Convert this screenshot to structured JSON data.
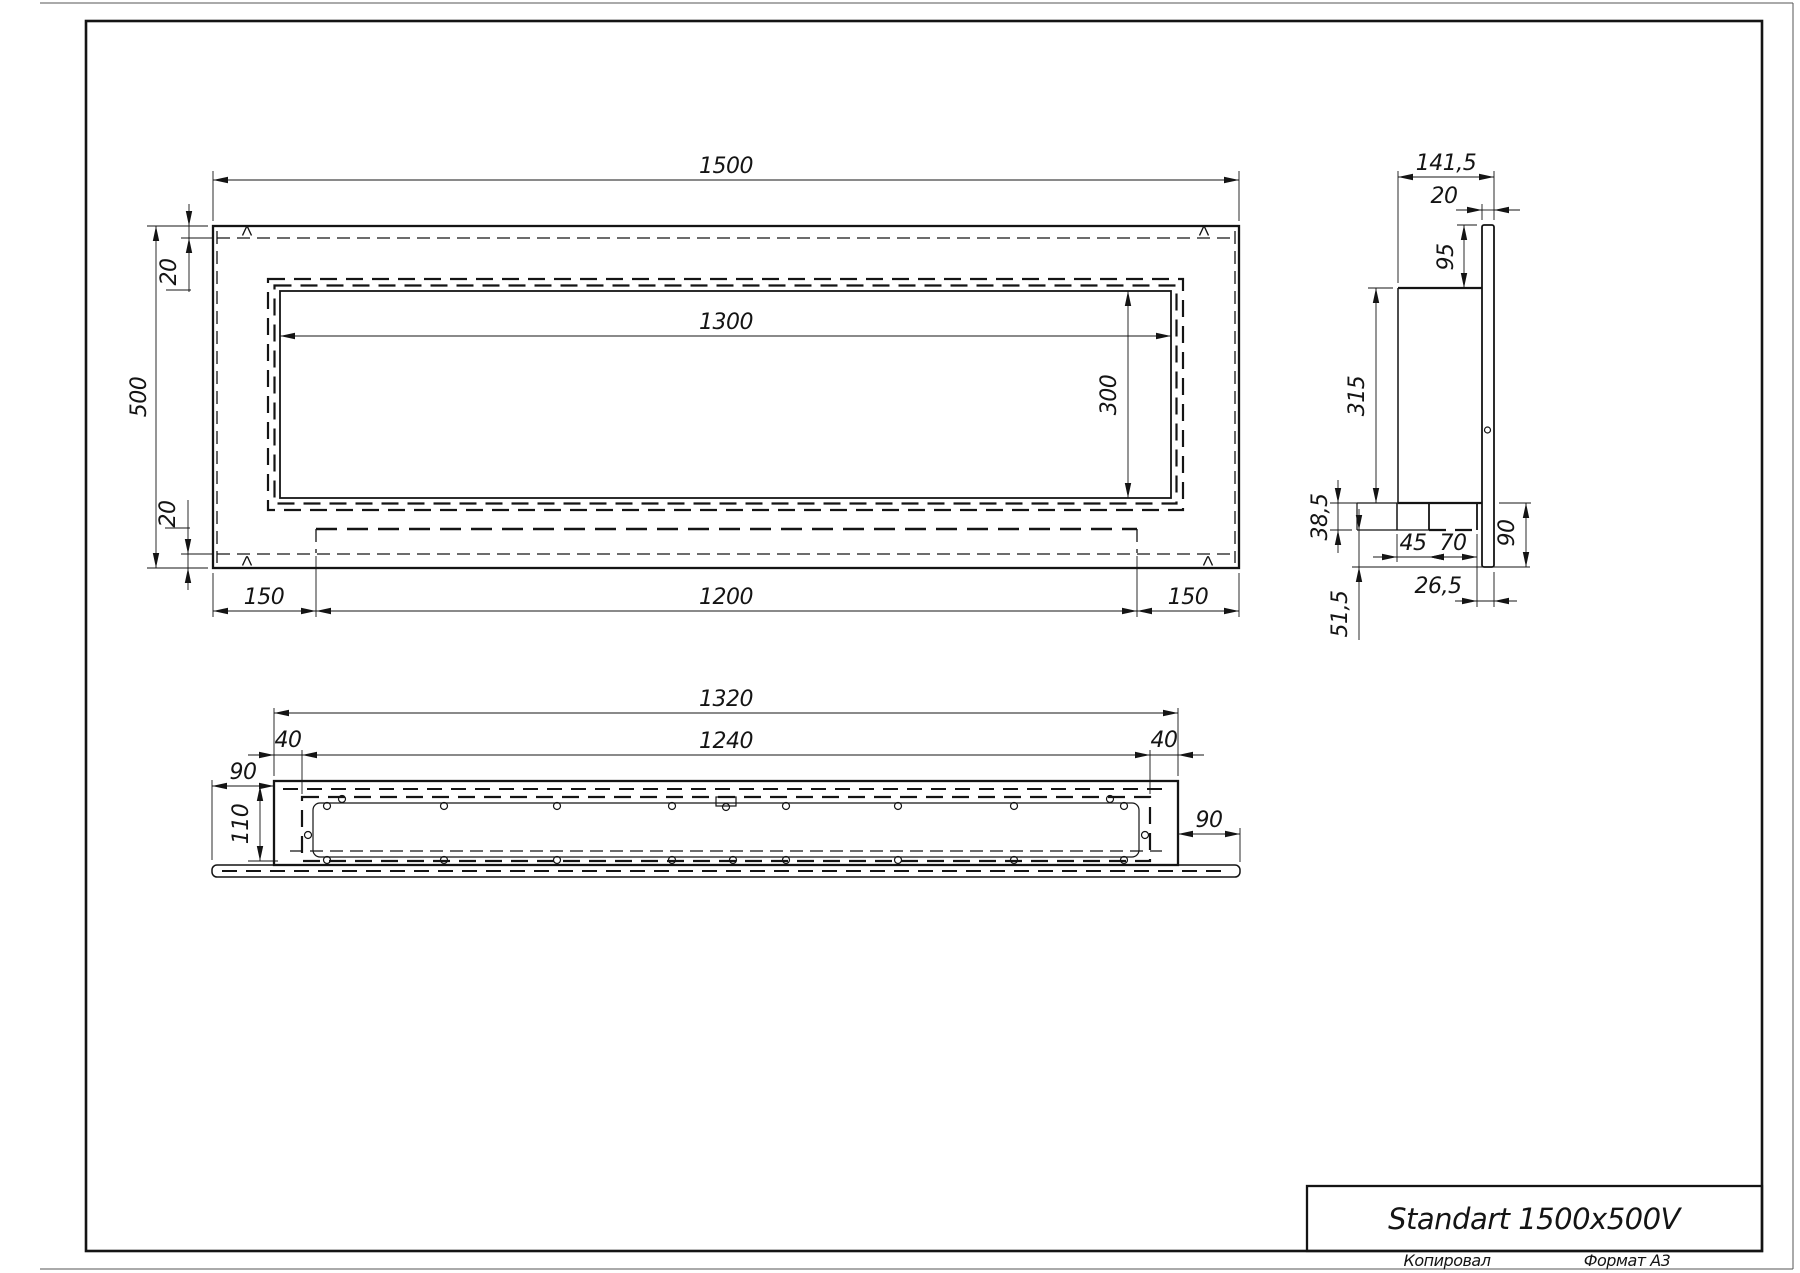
{
  "title_block": {
    "title": "Standart 1500x500V",
    "copied_label": "Копировал",
    "format_label": "Формат А3"
  },
  "front_view": {
    "dims": {
      "overall_width": "1500",
      "overall_height": "500",
      "opening_width": "1300",
      "opening_height": "300",
      "top_flange": "20",
      "bottom_flange": "20",
      "left_margin": "150",
      "tray_width": "1200",
      "right_margin": "150"
    }
  },
  "side_view": {
    "dims": {
      "overall_depth": "141,5",
      "plate_thickness": "20",
      "plate_top_offset": "95",
      "body_height": "315",
      "shelf_height": "38,5",
      "shelf_inset": "45",
      "burner_width": "70",
      "right_drop": "90",
      "back_offset": "26,5",
      "lower_drop": "51,5"
    }
  },
  "bottom_view": {
    "dims": {
      "body_length": "1320",
      "opening_length": "1240",
      "left_end": "40",
      "right_end": "40",
      "left_overhang": "90",
      "inner_depth": "110",
      "right_overhang": "90"
    }
  }
}
